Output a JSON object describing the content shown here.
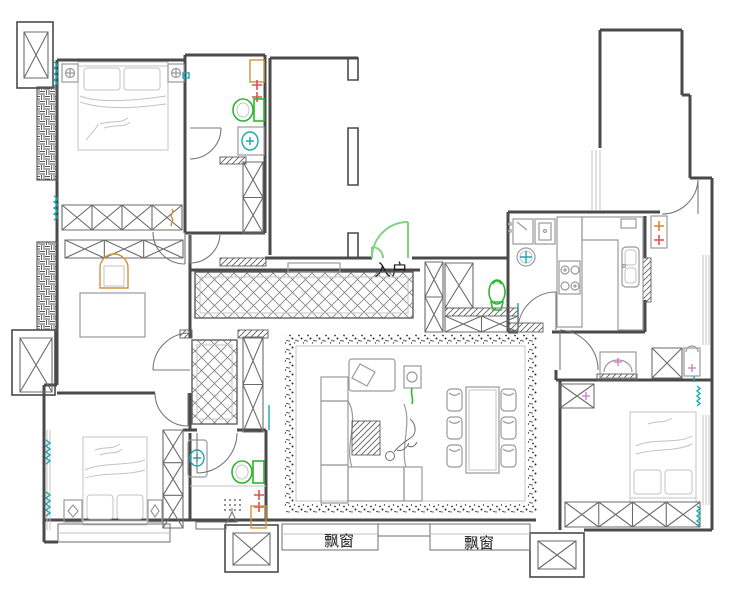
{
  "title": "apartment-floor-plan",
  "labels": {
    "entrance": "入户",
    "bay_window_left": "飘窗",
    "bay_window_right": "飘窗"
  },
  "colors": {
    "wall": "#4a4a4a",
    "furniture": "#9a9a9a",
    "light": "#c3c3c3",
    "door_green": "#7fd47f",
    "fixture_green": "#2fb52f",
    "curtain_teal": "#1aa8b0",
    "accent_red": "#e04f4f",
    "accent_orange": "#e08428",
    "cabinet_tan": "#cf9340",
    "accent_pink": "#d075c8",
    "background": "#ffffff"
  }
}
